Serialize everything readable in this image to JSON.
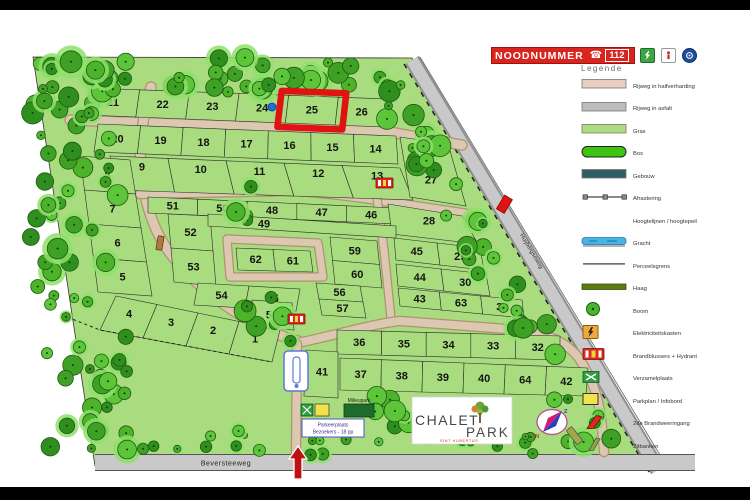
{
  "banner": {
    "label": "NOODNUMMER",
    "number": "112"
  },
  "header_icons": [
    {
      "name": "aed-icon",
      "color": "#3da545"
    },
    {
      "name": "first-aid-icon",
      "color": "#ffffff"
    },
    {
      "name": "info-icon",
      "color": "#1d4f9e"
    }
  ],
  "legend": {
    "title": "Legende",
    "items": [
      {
        "label": "Rijweg in halfverharding",
        "swatch": "rect",
        "color": "#e8cfc0"
      },
      {
        "label": "Rijweg in asfalt",
        "swatch": "rect",
        "color": "#bcbcbc"
      },
      {
        "label": "Gras",
        "swatch": "rect",
        "color": "#abdd80"
      },
      {
        "label": "Bos",
        "swatch": "oval",
        "color": "#3ec412"
      },
      {
        "label": "Gebouw",
        "swatch": "rect",
        "color": "#2e5d63"
      },
      {
        "label": "Afrastering",
        "swatch": "fence"
      },
      {
        "label": "Hoogtelijnen / hoogtepeil",
        "swatch": "blank"
      },
      {
        "label": "Gracht",
        "swatch": "water",
        "color": "#4ab4e6"
      },
      {
        "label": "Perceelsgrens",
        "swatch": "line"
      },
      {
        "label": "Haag",
        "swatch": "hedge",
        "color": "#5b7a10"
      },
      {
        "label": "Boom",
        "swatch": "tree",
        "color": "#49b52e"
      },
      {
        "label": "Elektriciteitskasten",
        "swatch": "power",
        "color": "#f0a93c"
      },
      {
        "label": "Brandblussers + Hydrant",
        "swatch": "hydrant",
        "color": "#d92b1f"
      },
      {
        "label": "Verzamelplaats",
        "swatch": "assembly",
        "color": "#2f9e41"
      },
      {
        "label": "Parkplan / Infobord",
        "swatch": "infoboard",
        "color": "#f2e34d"
      },
      {
        "label": "2de Brandweeringang",
        "swatch": "redbar",
        "color": "#d92b1f"
      },
      {
        "label": "Zitbanken",
        "swatch": "bench",
        "color": "#9aa23f"
      }
    ]
  },
  "map": {
    "park_fill": "#a8dc7e",
    "plot_fill": "#a8dc7e",
    "road_fill": "#dcc7b1",
    "road_edge": "#b09274",
    "asphalt_fill": "#c9c9c9",
    "highlight_color": "#e01212",
    "highlighted_plot": "25",
    "blue_marker": {
      "x": 272,
      "y": 107
    },
    "street_bottom": "Beversteeweg",
    "street_diagonal": "Huijbergseweg",
    "milieupark_label": "Milieupark",
    "parking_label": [
      "Parkeerplaats",
      "Bezoekers - 18 pp"
    ],
    "logo": {
      "word1": "CHALET",
      "word2": "PARK",
      "subtitle": "SINT HUBERTUS"
    },
    "compass": {
      "up": "Z",
      "down": "N"
    },
    "bands": [
      {
        "corners": [
          90,
          88,
          388,
          99,
          385,
          127,
          86,
          115
        ],
        "dir": "h",
        "plots": [
          "21",
          "22",
          "23",
          "24",
          "25",
          "26"
        ],
        "dy": 0
      },
      {
        "corners": [
          98,
          124,
          396,
          136,
          398,
          164,
          94,
          152
        ],
        "dir": "h",
        "plots": [
          "20",
          "19",
          "18",
          "17",
          "16",
          "15",
          "14"
        ],
        "dy": 0
      },
      {
        "corners": [
          110,
          156,
          400,
          168,
          413,
          200,
          115,
          190
        ],
        "dir": "h",
        "plots": [
          "9",
          "10",
          "11",
          "12",
          "13"
        ],
        "dy": -7
      },
      {
        "corners": [
          80,
          156,
          130,
          160,
          152,
          296,
          98,
          292
        ],
        "dir": "v",
        "plots": [
          "8",
          "7",
          "6",
          "5"
        ],
        "dy": 0
      },
      {
        "corners": [
          116,
          296,
          280,
          330,
          272,
          362,
          100,
          330
        ],
        "dir": "h",
        "plots": [
          "4",
          "3",
          "2",
          "1"
        ],
        "dy": -3
      },
      {
        "corners": [
          148,
          197,
          396,
          208,
          396,
          224,
          148,
          213
        ],
        "dir": "h",
        "plots": [
          "51",
          "50",
          "48",
          "47",
          "46"
        ],
        "dy": 0
      },
      {
        "corners": [
          168,
          214,
          210,
          216,
          216,
          286,
          174,
          282
        ],
        "dir": "v",
        "plots": [
          "52",
          "53"
        ],
        "dy": 0
      },
      {
        "corners": [
          236,
          248,
          310,
          251,
          313,
          272,
          238,
          270
        ],
        "dir": "h",
        "plots": [
          "62",
          "61"
        ],
        "dy": 0
      },
      {
        "corners": [
          330,
          237,
          377,
          241,
          382,
          288,
          335,
          284
        ],
        "dir": "v",
        "plots": [
          "59",
          "60"
        ],
        "dy": 0
      },
      {
        "corners": [
          394,
          238,
          480,
          248,
          484,
          270,
          396,
          260
        ],
        "dir": "h",
        "plots": [
          "45",
          "29"
        ],
        "dy": 0
      },
      {
        "corners": [
          396,
          264,
          486,
          274,
          490,
          296,
          398,
          286
        ],
        "dir": "h",
        "plots": [
          "44",
          "30"
        ],
        "dy": 0
      },
      {
        "corners": [
          398,
          288,
          522,
          300,
          524,
          318,
          400,
          306
        ],
        "dir": "h",
        "plots": [
          "43",
          "63",
          "31"
        ],
        "dy": 0
      },
      {
        "corners": [
          337,
          330,
          560,
          336,
          560,
          360,
          337,
          354
        ],
        "dir": "h",
        "plots": [
          "36",
          "35",
          "34",
          "33",
          "32"
        ],
        "dy": 0
      },
      {
        "corners": [
          340,
          358,
          588,
          368,
          586,
          396,
          340,
          390
        ],
        "dir": "h",
        "plots": [
          "37",
          "38",
          "39",
          "40",
          "64",
          "42"
        ],
        "dy": 0
      },
      {
        "corners": [
          198,
          283,
          300,
          289,
          296,
          311,
          194,
          305
        ],
        "dir": "h",
        "plots": [
          "54",
          "55"
        ],
        "dy": 0
      },
      {
        "corners": [
          316,
          283,
          360,
          286,
          366,
          318,
          322,
          315
        ],
        "dir": "v",
        "plots": [
          "56",
          "57"
        ],
        "dy": 0
      }
    ],
    "single_plots": [
      {
        "n": "27",
        "poly": [
          400,
          137,
          448,
          144,
          466,
          206,
          410,
          197
        ],
        "label": [
          431,
          180
        ]
      },
      {
        "n": "28",
        "poly": [
          388,
          204,
          462,
          216,
          478,
          244,
          392,
          234
        ],
        "label": [
          429,
          221
        ]
      },
      {
        "n": "49",
        "poly": [
          208,
          214,
          396,
          226,
          396,
          238,
          208,
          226
        ],
        "label": [
          264,
          224
        ]
      },
      {
        "n": "41",
        "poly": [
          306,
          350,
          338,
          352,
          338,
          398,
          304,
          396
        ],
        "label": [
          322,
          372
        ]
      },
      {
        "n": "58",
        "poly": [
          252,
          300,
          292,
          303,
          294,
          330,
          254,
          327
        ],
        "label": [
          272,
          315
        ]
      }
    ]
  }
}
